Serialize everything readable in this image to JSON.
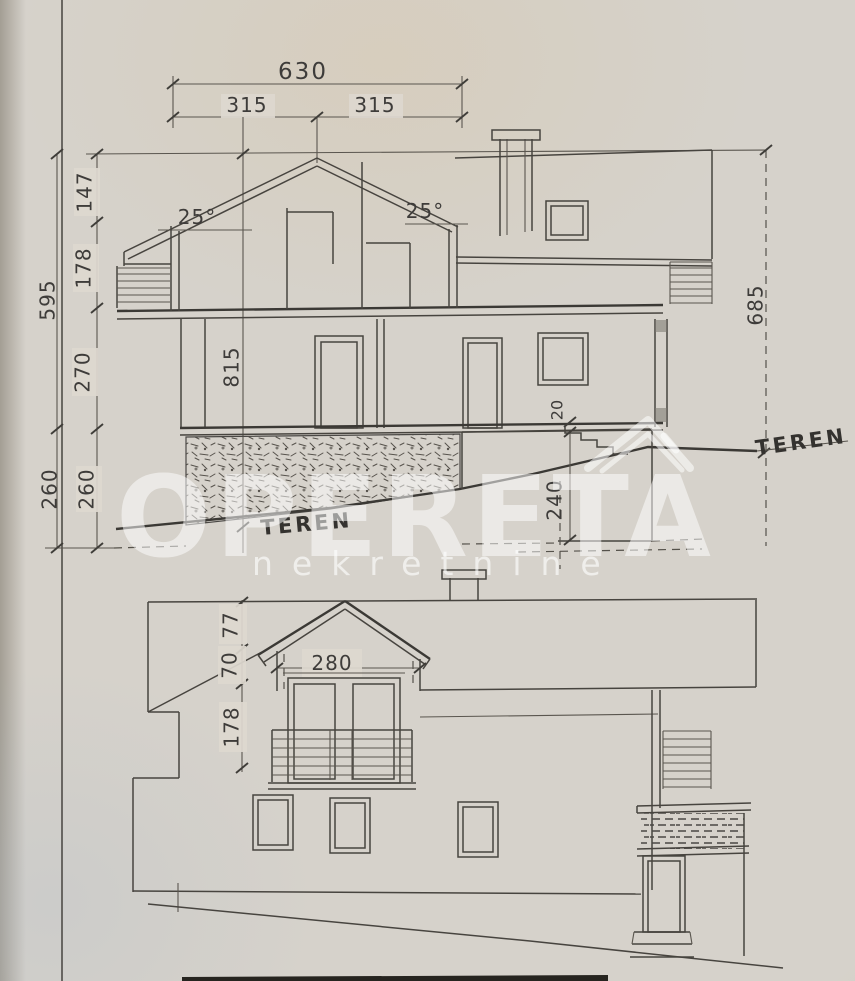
{
  "watermark": {
    "brand": "OPERETA",
    "tagline": "nekretnine"
  },
  "section": {
    "dims": {
      "total_width": "630",
      "left_half": "315",
      "right_half": "315",
      "roof_rise": "147",
      "attic_storey": "178",
      "main_storey": "270",
      "overall_left": "595",
      "basement_outer": "260",
      "basement_inner": "260",
      "overall_right": "685",
      "slab_thickness": "20",
      "basement_room": "240",
      "ridge_height": "815"
    },
    "angles": {
      "left": "25°",
      "right": "25°"
    },
    "terrain_left": "TEREN",
    "terrain_right": "TEREN"
  },
  "elevation": {
    "dims": {
      "dormer_rise": "77",
      "dormer_knee": "70",
      "dormer_width": "280",
      "storey": "178"
    }
  }
}
